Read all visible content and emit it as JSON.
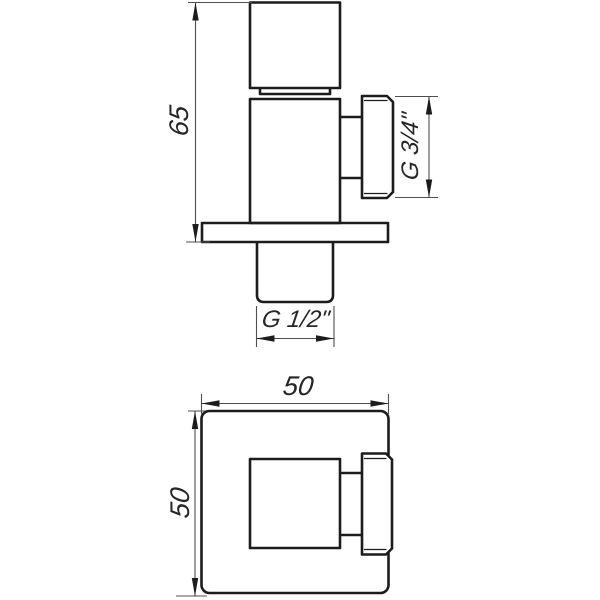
{
  "dimensions": {
    "overall_height": "65",
    "side_thread": "G 3/4\"",
    "bottom_thread": "G 1/2\"",
    "plan_width": "50",
    "plan_height": "50"
  },
  "colors": {
    "object_line": "#1c1c1c",
    "dimension_line": "#4f4f4f",
    "text": "#262626",
    "background": "#ffffff"
  }
}
